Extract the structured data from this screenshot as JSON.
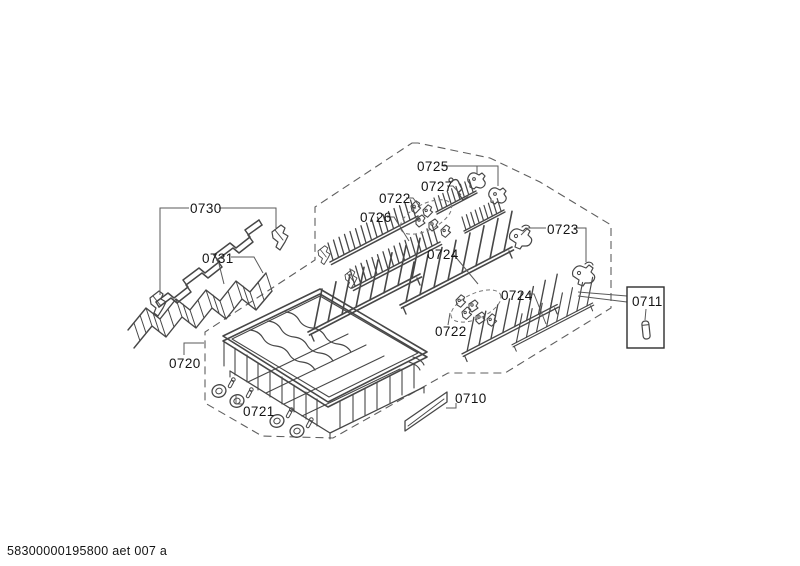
{
  "footer": {
    "document_code": "58300000195800 aet 007 a"
  },
  "parts": {
    "0710": {
      "label": "0710"
    },
    "0711": {
      "label": "0711"
    },
    "0720": {
      "label": "0720"
    },
    "0721": {
      "label": "0721"
    },
    "0722": {
      "label": "0722"
    },
    "0723": {
      "label": "0723"
    },
    "0724": {
      "label": "0724"
    },
    "0725": {
      "label": "0725"
    },
    "0726": {
      "label": "0726"
    },
    "0727": {
      "label": "0727"
    },
    "0730": {
      "label": "0730"
    },
    "0731": {
      "label": "0731"
    }
  },
  "colors": {
    "background": "#ffffff",
    "line": "#474747",
    "dashed_outline": "#5f5f5f",
    "label_text": "#141414"
  }
}
